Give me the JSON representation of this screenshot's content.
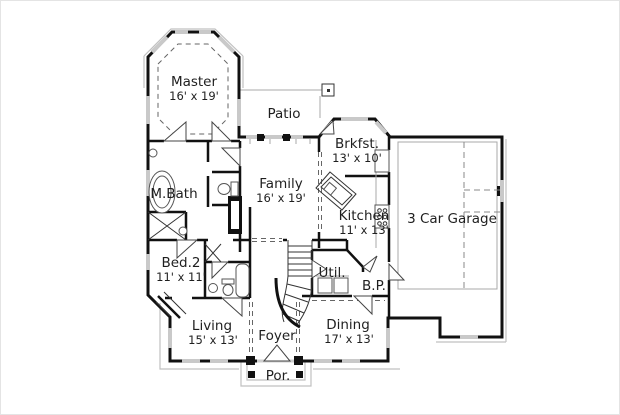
{
  "colors": {
    "wall": "#111111",
    "window": "#c9c9c9",
    "text": "#1f1f1f",
    "background": "#ffffff"
  },
  "rooms": {
    "master": {
      "name": "Master",
      "dims": "16' x 19'"
    },
    "patio": {
      "name": "Patio",
      "dims": ""
    },
    "brkfst": {
      "name": "Brkfst.",
      "dims": "13' x 10'"
    },
    "family": {
      "name": "Family",
      "dims": "16' x 19'"
    },
    "kitchen": {
      "name": "Kitchen",
      "dims": "11' x 13'"
    },
    "garage": {
      "name": "3 Car Garage",
      "dims": ""
    },
    "mbath": {
      "name": "M.Bath",
      "dims": ""
    },
    "bed2": {
      "name": "Bed.2",
      "dims": "11' x 11'"
    },
    "util": {
      "name": "Util.",
      "dims": ""
    },
    "bp": {
      "name": "B.P.",
      "dims": ""
    },
    "living": {
      "name": "Living",
      "dims": "15' x 13'"
    },
    "foyer": {
      "name": "Foyer",
      "dims": ""
    },
    "dining": {
      "name": "Dining",
      "dims": "17' x 13'"
    },
    "porch": {
      "name": "Por.",
      "dims": ""
    }
  }
}
